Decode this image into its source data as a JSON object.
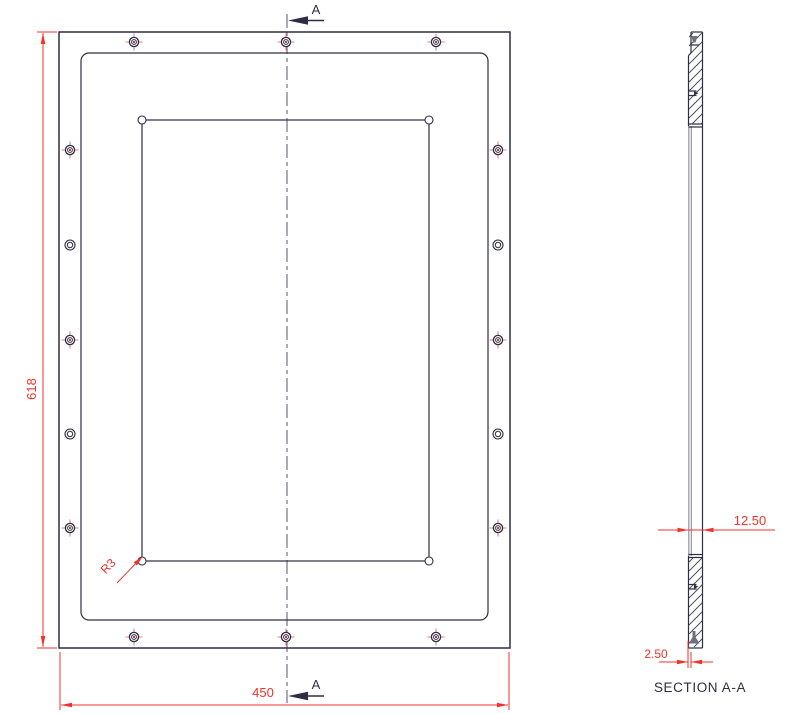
{
  "drawing": {
    "front": {
      "height_dim": "618",
      "width_dim": "450",
      "fillet": "R3"
    },
    "section": {
      "label": "SECTION A-A",
      "thickness": "12.50",
      "web": "2.50"
    },
    "cut": {
      "top": "A",
      "bottom": "A"
    }
  },
  "colors": {
    "line": "#2d2d44",
    "dim_red": "#f0322a",
    "tick_red": "#f27c7c",
    "center_red": "#b23030",
    "hatch": "#45455f",
    "gray": "#8c8c9a",
    "countersink_gray": "#6f6f7f",
    "background": "#ffffff"
  }
}
